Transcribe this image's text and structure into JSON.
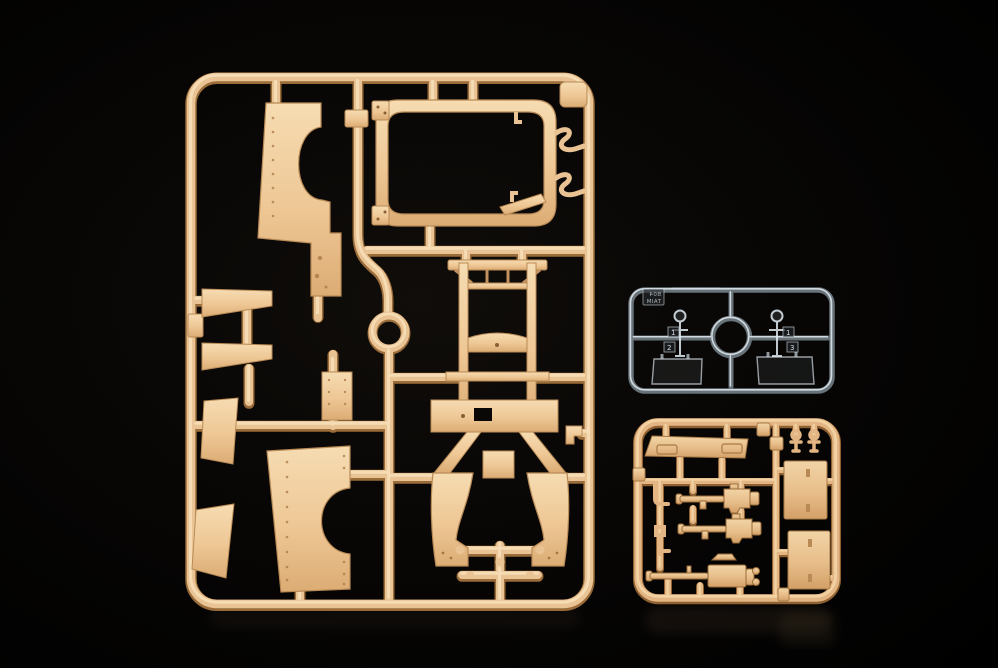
{
  "image": {
    "type": "photograph",
    "subject": "Plastic scale-model kit sprues (injection-moulded runners with parts) on a black background",
    "width_px": 998,
    "height_px": 668
  },
  "palette": {
    "background": "#030303",
    "tan_plastic_mid": "#e9c394",
    "tan_plastic_light": "#f7e0ba",
    "tan_plastic_dark": "#9a6c39",
    "small_sprue_tan": "#e3b583",
    "clear_plastic_edge": "#e3ecf2"
  },
  "sprues": {
    "large_tan": {
      "name": "large tan body-panel sprue",
      "description": "Tall rectangular runner frame holding fender panels with wheel-arch cutouts, a windscreen frame, a chassis ladder, floor panels, running boards and two curved mudguards, plus a circular runner ring",
      "parts": [
        "front-fender-panel",
        "windscreen-frame",
        "runner-ring",
        "chassis-ladder",
        "floor-panel",
        "left-mudguard",
        "right-mudguard",
        "running-board-upper",
        "running-board-lower",
        "side-panel-upper",
        "side-panel-lower",
        "rear-fender-panel",
        "hinge-hook-upper",
        "hinge-hook-lower",
        "corner-bracket"
      ]
    },
    "clear": {
      "name": "clear parts sprue",
      "description": "Small transparent sprue with two glazing panels, two lamp lenses, a central runner ring and an embossed code tag",
      "tag_lines": [
        "B04",
        "TAIM"
      ],
      "tabs": [
        {
          "label": "1"
        },
        {
          "label": "2"
        },
        {
          "label": "1"
        },
        {
          "label": "3"
        }
      ]
    },
    "small_tan": {
      "name": "small tan detail sprue",
      "description": "Small runner frame with a windscreen top panel, two door panels, three machine guns, lever hooks and lamp stalks",
      "parts": [
        "windscreen-top-panel",
        "door-panel-upper",
        "door-panel-lower",
        "machine-gun-1",
        "machine-gun-2",
        "machine-gun-3",
        "lever-hook-upper",
        "lever-hook-lower",
        "lamp-stalk-1",
        "lamp-stalk-2"
      ]
    }
  }
}
